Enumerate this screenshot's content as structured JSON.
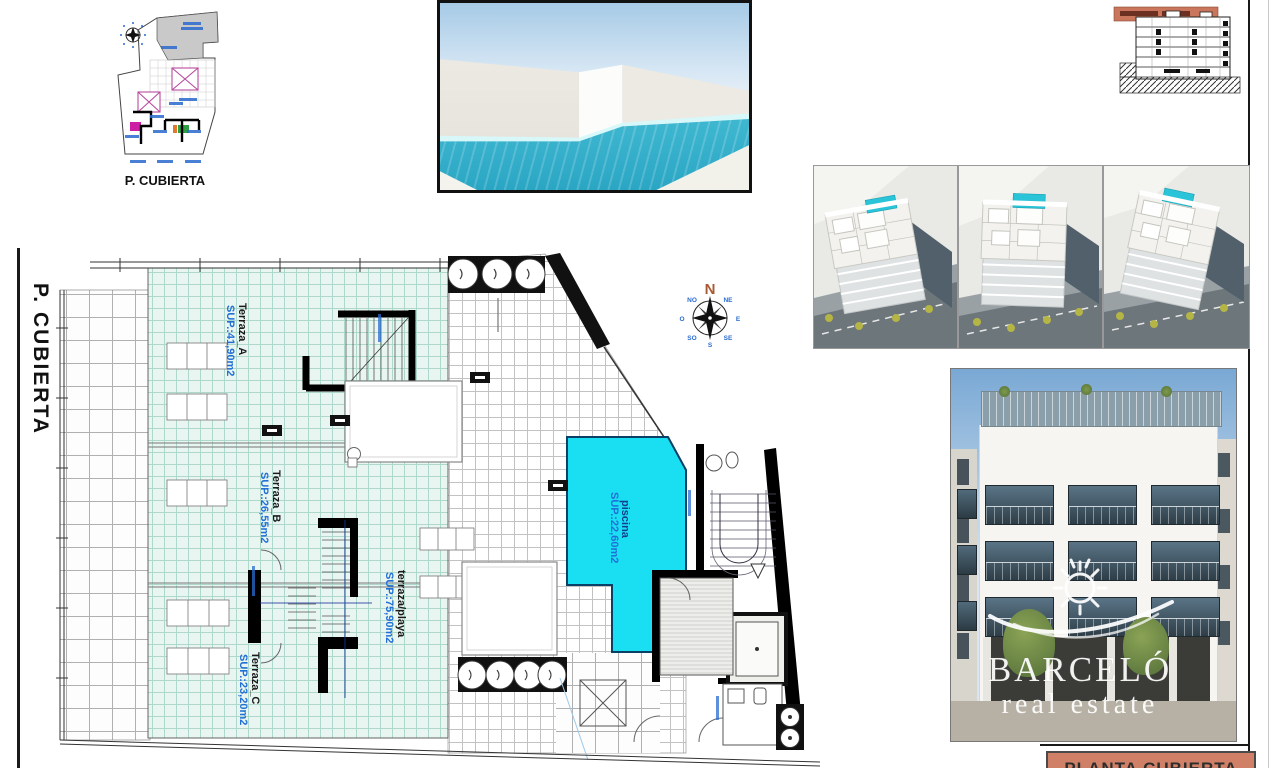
{
  "sheet": {
    "side_label": "P. CUBIERTA"
  },
  "key_plan": {
    "caption": "P. CUBIERTA"
  },
  "compass": {
    "north": "N",
    "dirs": [
      "NO",
      "O",
      "SO",
      "S",
      "SE",
      "E",
      "NE"
    ]
  },
  "plan": {
    "rooms": [
      {
        "name": "Terraza_A",
        "area": "SUP.:41,90m2"
      },
      {
        "name": "Terraza_B",
        "area": "SUP.:26,55m2"
      },
      {
        "name": "Terraza_C",
        "area": "SUP.:23,20m2"
      },
      {
        "name": "terraza/playa",
        "area": "SUP.:75,90m2"
      },
      {
        "name": "piscina",
        "area": "SUP.:22,60m2"
      }
    ]
  },
  "title_block": {
    "title": "PLANTA CUBIERTA"
  },
  "watermark": {
    "brand": "BARCELÓ",
    "tagline": "real estate"
  },
  "colors": {
    "pool": "#1adef2",
    "terrace_tile": "#e8f5f1",
    "accent_blue": "#1f6fd6",
    "salmon": "#d08067"
  }
}
